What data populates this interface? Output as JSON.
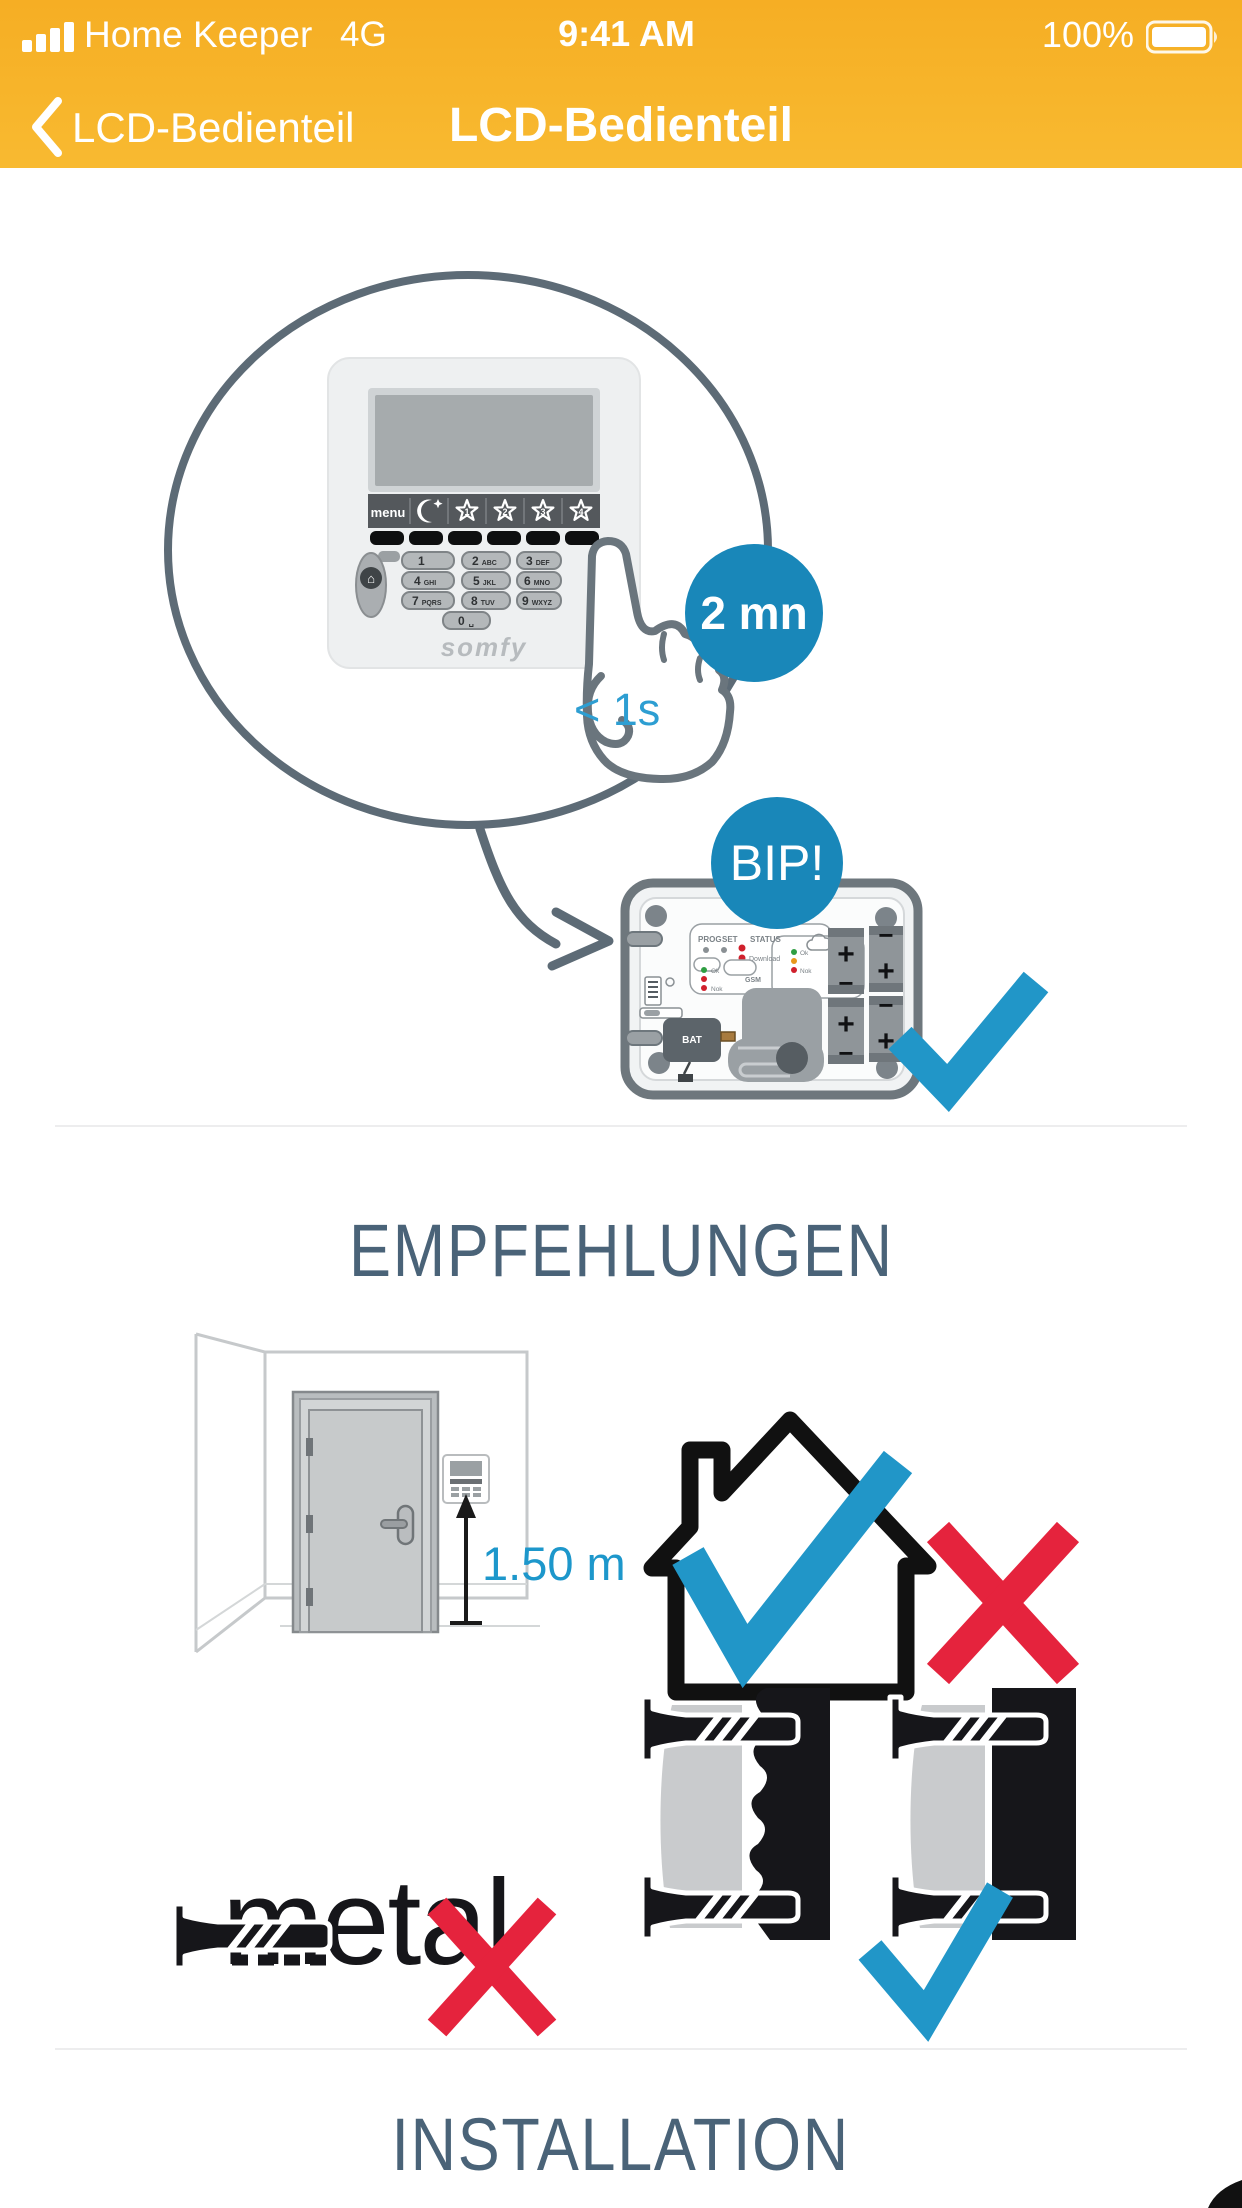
{
  "status_bar": {
    "carrier": "Home Keeper",
    "network": "4G",
    "time": "9:41 AM",
    "battery_percent": "100%"
  },
  "nav": {
    "back_label": "LCD-Bedienteil",
    "title": "LCD-Bedienteil"
  },
  "hero": {
    "press_duration": "< 1s",
    "wait_badge": "2 mn",
    "beep_badge": "BIP!"
  },
  "keypad": {
    "menu_label": "menu",
    "star_numbers": [
      "1",
      "2",
      "3",
      "4"
    ],
    "keys": [
      [
        "1",
        ""
      ],
      [
        "2",
        "ABC"
      ],
      [
        "3",
        "DEF"
      ],
      [
        "4",
        "GHI"
      ],
      [
        "5",
        "JKL"
      ],
      [
        "6",
        "MNO"
      ],
      [
        "7",
        "PQRS"
      ],
      [
        "8",
        "TUV"
      ],
      [
        "9",
        "WXYZ"
      ],
      [
        "0",
        "␣"
      ]
    ],
    "brand": "somfy"
  },
  "keypad_back": {
    "labels": {
      "prog": "PROG",
      "set": "SET",
      "status": "STATUS",
      "download": "Download",
      "ok": "Ok",
      "nok": "Nok",
      "gsm": "GSM",
      "bat": "BAT",
      "volt": "5V"
    },
    "battery_polarity": [
      {
        "top": "+",
        "bottom": "−"
      },
      {
        "top": "+",
        "bottom": "−"
      },
      {
        "top": "−",
        "bottom": "+"
      },
      {
        "top": "−",
        "bottom": "+"
      }
    ]
  },
  "recommendations": {
    "title": "EMPFEHLUNGEN",
    "mount_height": "1.50 m",
    "metal_label": "metal"
  },
  "installation": {
    "title": "INSTALLATION"
  },
  "colors": {
    "accent_yellow": "#f7b52b",
    "badge_blue": "#1987b9",
    "check_blue": "#2196c8",
    "cross_red": "#e5233d",
    "heading_slate": "#4a6378",
    "hint_blue": "#2d9ed2"
  }
}
